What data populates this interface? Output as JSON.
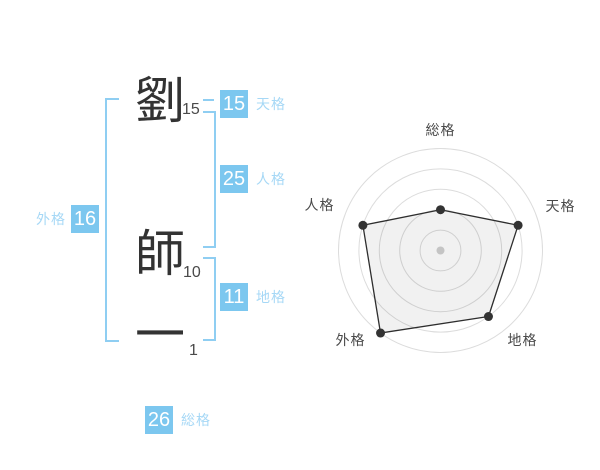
{
  "name_panel": {
    "characters": [
      {
        "char": "劉",
        "strokes": "15"
      },
      {
        "char": "師",
        "strokes": "10"
      },
      {
        "char": "一",
        "strokes": "1"
      }
    ],
    "badges": {
      "tenkaku": {
        "value": "15",
        "label": "天格"
      },
      "jinkaku": {
        "value": "25",
        "label": "人格"
      },
      "chikaku": {
        "value": "11",
        "label": "地格"
      },
      "gaikaku": {
        "value": "16",
        "label": "外格"
      },
      "soukaku": {
        "value": "26",
        "label": "総格"
      }
    },
    "colors": {
      "accent_blue": "#7cc7ef",
      "label_blue": "#a6d8f6",
      "bracket_blue": "#8fcef2",
      "text_dark": "#333333"
    }
  },
  "chart_data": {
    "type": "radar",
    "categories": [
      "総格",
      "天格",
      "地格",
      "外格",
      "人格"
    ],
    "values": [
      2,
      4,
      4,
      5,
      4
    ],
    "max": 5,
    "rings": 5,
    "legend": "none",
    "grid_color": "#dcdcdc",
    "line_color": "#2e2e2e",
    "dot_color": "#333333",
    "center_dot_color": "#c4c4c4",
    "fill_color": "rgba(0,0,0,0.055)"
  }
}
